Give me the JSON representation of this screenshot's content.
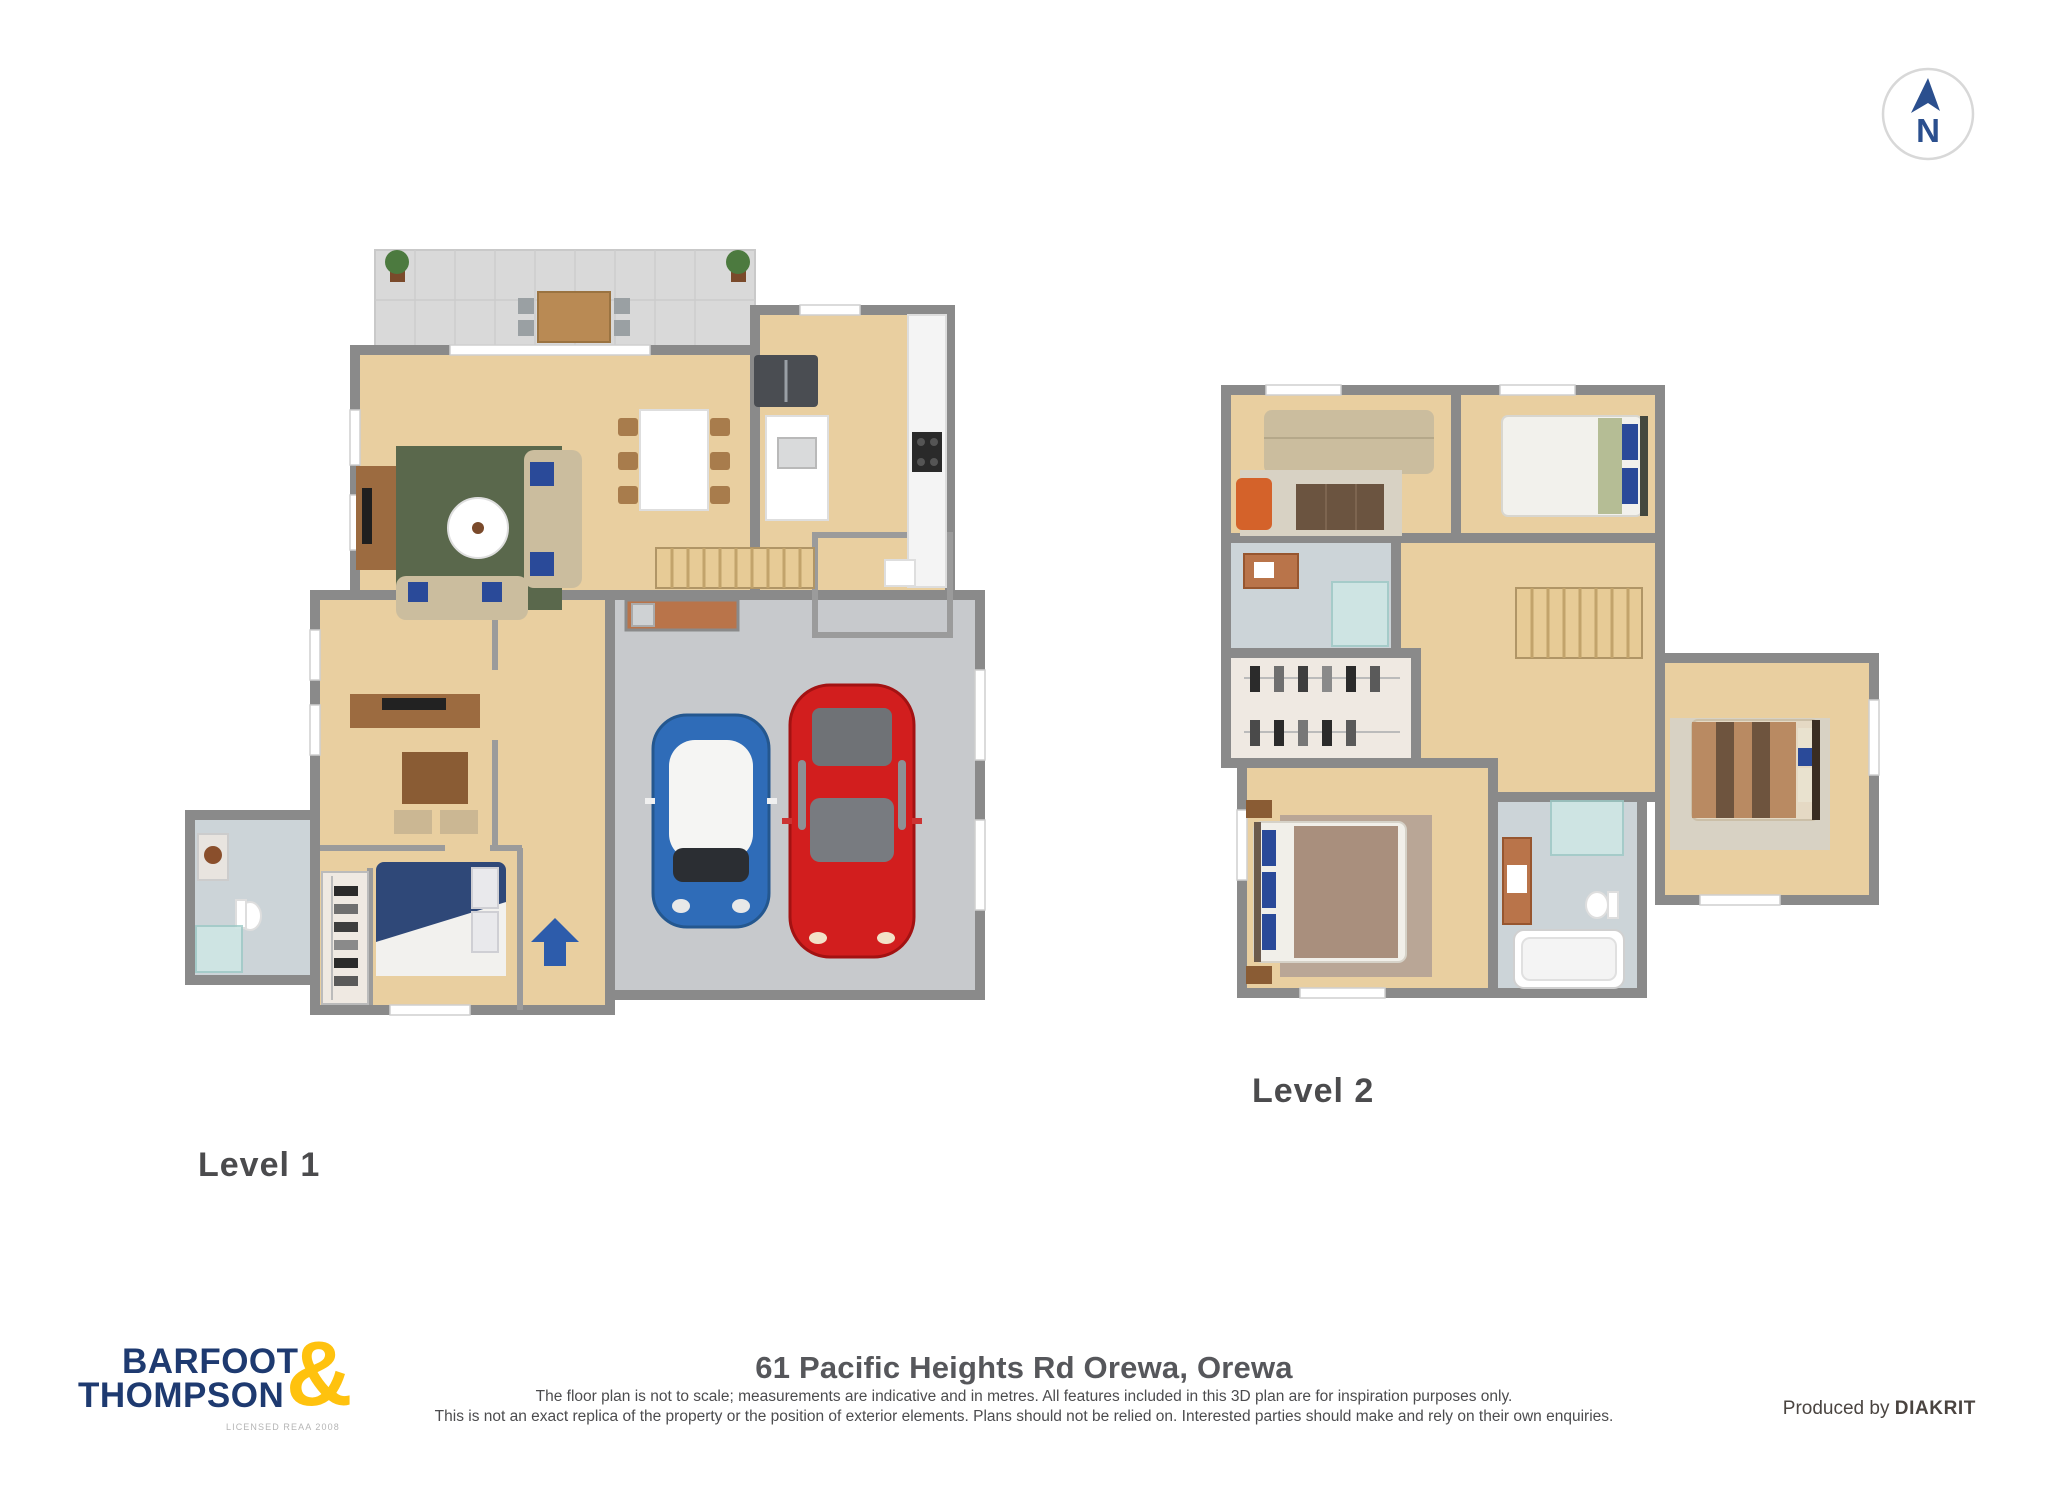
{
  "compass": {
    "letter": "N"
  },
  "levels": [
    {
      "label": "Level 1"
    },
    {
      "label": "Level 2"
    }
  ],
  "footer": {
    "brand": {
      "line1": "BARFOOT",
      "line2": "THOMPSON",
      "ampersand": "&",
      "license": "LICENSED REAA 2008"
    },
    "title": "61 Pacific Heights Rd Orewa, Orewa",
    "disclaimer_line1": "The floor plan is not to scale; measurements are indicative and in metres. All features included in this 3D plan are for inspiration purposes only.",
    "disclaimer_line2": "This is not an exact replica of the property or the position of exterior elements. Plans should not be relied on. Interested parties should make and rely on their own enquiries.",
    "produced_by": "Produced by",
    "producer": "DIAKRIT"
  },
  "palette": {
    "wall": "#8a8a8a",
    "wood": "#e9cfa0",
    "wood-light": "#efe9e2",
    "patio": "#d9d9d9",
    "concrete": "#c7c9cc",
    "tile": "#ccd4d8",
    "rug-green": "#5a684c",
    "sofa": "#cbbd9e",
    "pillow-blue": "#2a4a99",
    "car-blue": "#2f6cb8",
    "car-red": "#d21e1e",
    "stairs": "#e7cb96",
    "stair-line": "#c2a36b",
    "copper": "#b9744a",
    "wood-furn": "#9c6b40",
    "glass": "#cfe8e6",
    "shag": "#d8d2c4",
    "rug-brown": "#b9a696",
    "duvet-navy": "#2f4878",
    "duvet-brown": "#a98f7d",
    "arrow-blue": "#2d5cab",
    "compass-blue": "#2b4f8e",
    "navy": "#1e3a70",
    "yellow": "#ffc20e",
    "text-dark": "#56575b",
    "text-gray": "#4c4c4e"
  }
}
